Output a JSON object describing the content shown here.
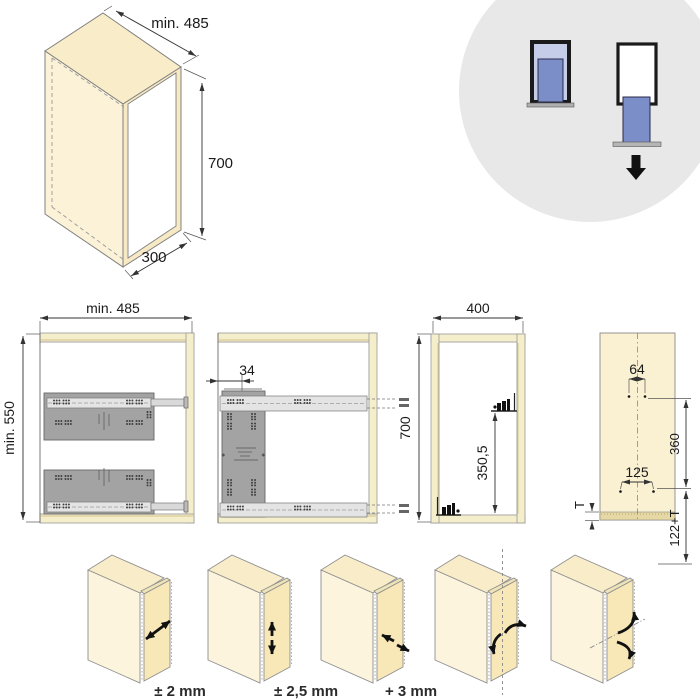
{
  "views": {
    "isometric": {
      "width": "min. 485",
      "height": "700",
      "depth": "300"
    },
    "front": {
      "width": "min. 485",
      "height": "min. 550"
    },
    "side": {
      "plate_offset": "34"
    },
    "mounting": {
      "width": "400",
      "height": "700",
      "bracket_height": "350,5"
    },
    "door_panel": {
      "top_hole_spacing": "64",
      "bottom_hole_spacing": "125",
      "hole_row_distance": "360",
      "bottom_edge_distance": "122+T",
      "panel_thickness": "T"
    }
  },
  "adjustments": [
    {
      "label": "± 2 mm",
      "type": "depth"
    },
    {
      "label": "± 2,5 mm",
      "type": "height"
    },
    {
      "label": "+ 3 mm",
      "type": "side"
    }
  ],
  "icons": {
    "pictogram_closed": "pullout-closed-icon",
    "pictogram_extended": "pullout-extended-icon",
    "pictogram_arrow": "down-arrow-icon"
  },
  "colors": {
    "wood": "#FAF0D2",
    "wood_edge": "#D2C28C",
    "frame": "#F5EECB",
    "plate_gray": "#A3A3A3",
    "rail_gray": "#E4E4E4",
    "circle_bg": "#E8E8E8",
    "blue_dark": "#7B8EC8",
    "blue_light": "#C5CDE9",
    "line": "#333333"
  }
}
